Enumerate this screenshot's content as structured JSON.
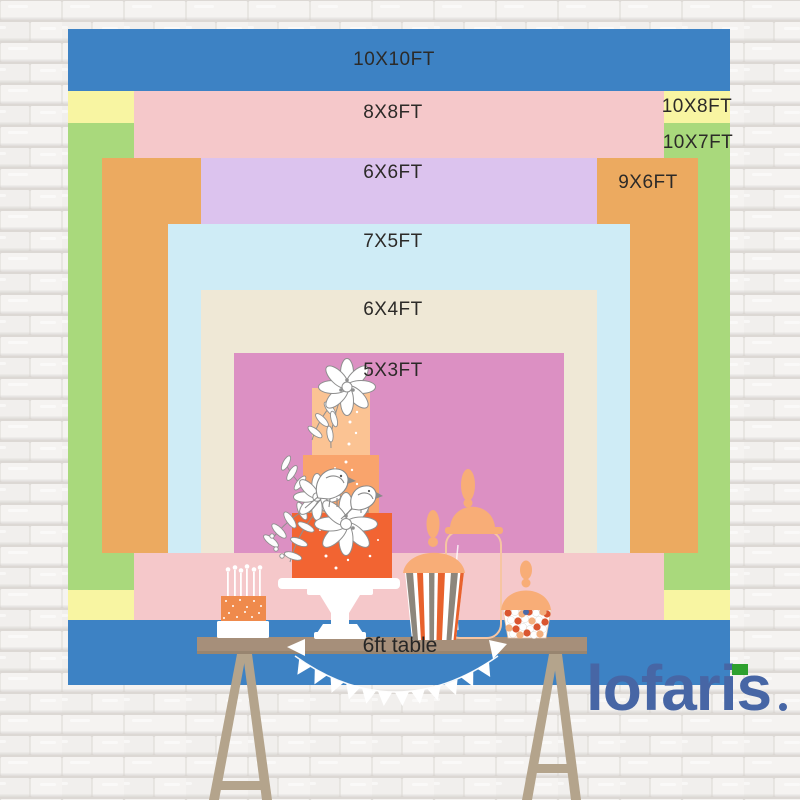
{
  "backdrop_sizes": [
    {
      "label": "10X10FT",
      "width_ft": 10,
      "height_ft": 10,
      "color": "#3d82c4",
      "rect": {
        "x": 68,
        "y": 29,
        "w": 662,
        "h": 656
      },
      "label_pos": {
        "x": 394,
        "y": 60
      }
    },
    {
      "label": "10X8FT",
      "width_ft": 10,
      "height_ft": 8,
      "color": "#f8f5a2",
      "rect": {
        "x": 68,
        "y": 91,
        "w": 662,
        "h": 529
      },
      "label_pos": {
        "x": 697,
        "y": 107
      }
    },
    {
      "label": "10X7FT",
      "width_ft": 10,
      "height_ft": 7,
      "color": "#a9d97c",
      "rect": {
        "x": 68,
        "y": 123,
        "w": 662,
        "h": 467
      },
      "label_pos": {
        "x": 698,
        "y": 143
      }
    },
    {
      "label": "8X8FT",
      "width_ft": 8,
      "height_ft": 8,
      "color": "#f5c8ca",
      "rect": {
        "x": 134,
        "y": 91,
        "w": 530,
        "h": 529
      },
      "label_pos": {
        "x": 393,
        "y": 113
      }
    },
    {
      "label": "9X6FT",
      "width_ft": 9,
      "height_ft": 6,
      "color": "#ecaa60",
      "rect": {
        "x": 102,
        "y": 158,
        "w": 596,
        "h": 395
      },
      "label_pos": {
        "x": 648,
        "y": 183
      }
    },
    {
      "label": "6X6FT",
      "width_ft": 6,
      "height_ft": 6,
      "color": "#dcc3ee",
      "rect": {
        "x": 201,
        "y": 158,
        "w": 396,
        "h": 395
      },
      "label_pos": {
        "x": 393,
        "y": 173
      }
    },
    {
      "label": "7X5FT",
      "width_ft": 7,
      "height_ft": 5,
      "color": "#cfecf6",
      "rect": {
        "x": 168,
        "y": 224,
        "w": 462,
        "h": 329
      },
      "label_pos": {
        "x": 393,
        "y": 242
      }
    },
    {
      "label": "6X4FT",
      "width_ft": 6,
      "height_ft": 4,
      "color": "#efe8d6",
      "rect": {
        "x": 201,
        "y": 290,
        "w": 396,
        "h": 263
      },
      "label_pos": {
        "x": 393,
        "y": 310
      }
    },
    {
      "label": "5X3FT",
      "width_ft": 5,
      "height_ft": 3,
      "color": "#dc90c3",
      "rect": {
        "x": 234,
        "y": 353,
        "w": 330,
        "h": 200
      },
      "label_pos": {
        "x": 393,
        "y": 371
      }
    }
  ],
  "table": {
    "label": "6ft table"
  },
  "logo": {
    "text": "lofaris",
    "color": "#4766a5",
    "accent_color": "#2ea12e"
  },
  "wall": {
    "mortar_color": "#dcd8d4",
    "brick_color_a": "#f5f3f1",
    "brick_color_b": "#f1efed"
  },
  "illustration": {
    "table_color": "#a68f7a",
    "table_edge_color": "#93806c",
    "leg_color": "#b4a48c",
    "bunting_color": "#ffffff",
    "cake": {
      "tier_top": "#fbc393",
      "tier_mid": "#f9a46c",
      "tier_bottom": "#f26432",
      "stand": "#ffffff",
      "outline": "#8a8a8a"
    },
    "mini_cake": {
      "base": "#ffffff",
      "body": "#ef8a4c",
      "candles": "#ffffff"
    },
    "jars": {
      "lid": "#f8ad77",
      "stripe_orange": "#e8622d",
      "stripe_taupe": "#8d867c",
      "glass_outline": "#f6c5a2",
      "candy_orange": "#da5630",
      "candy_peach": "#f2ae7d",
      "candy_blue": "#4a69a8",
      "candy_white": "#ffffff"
    }
  }
}
